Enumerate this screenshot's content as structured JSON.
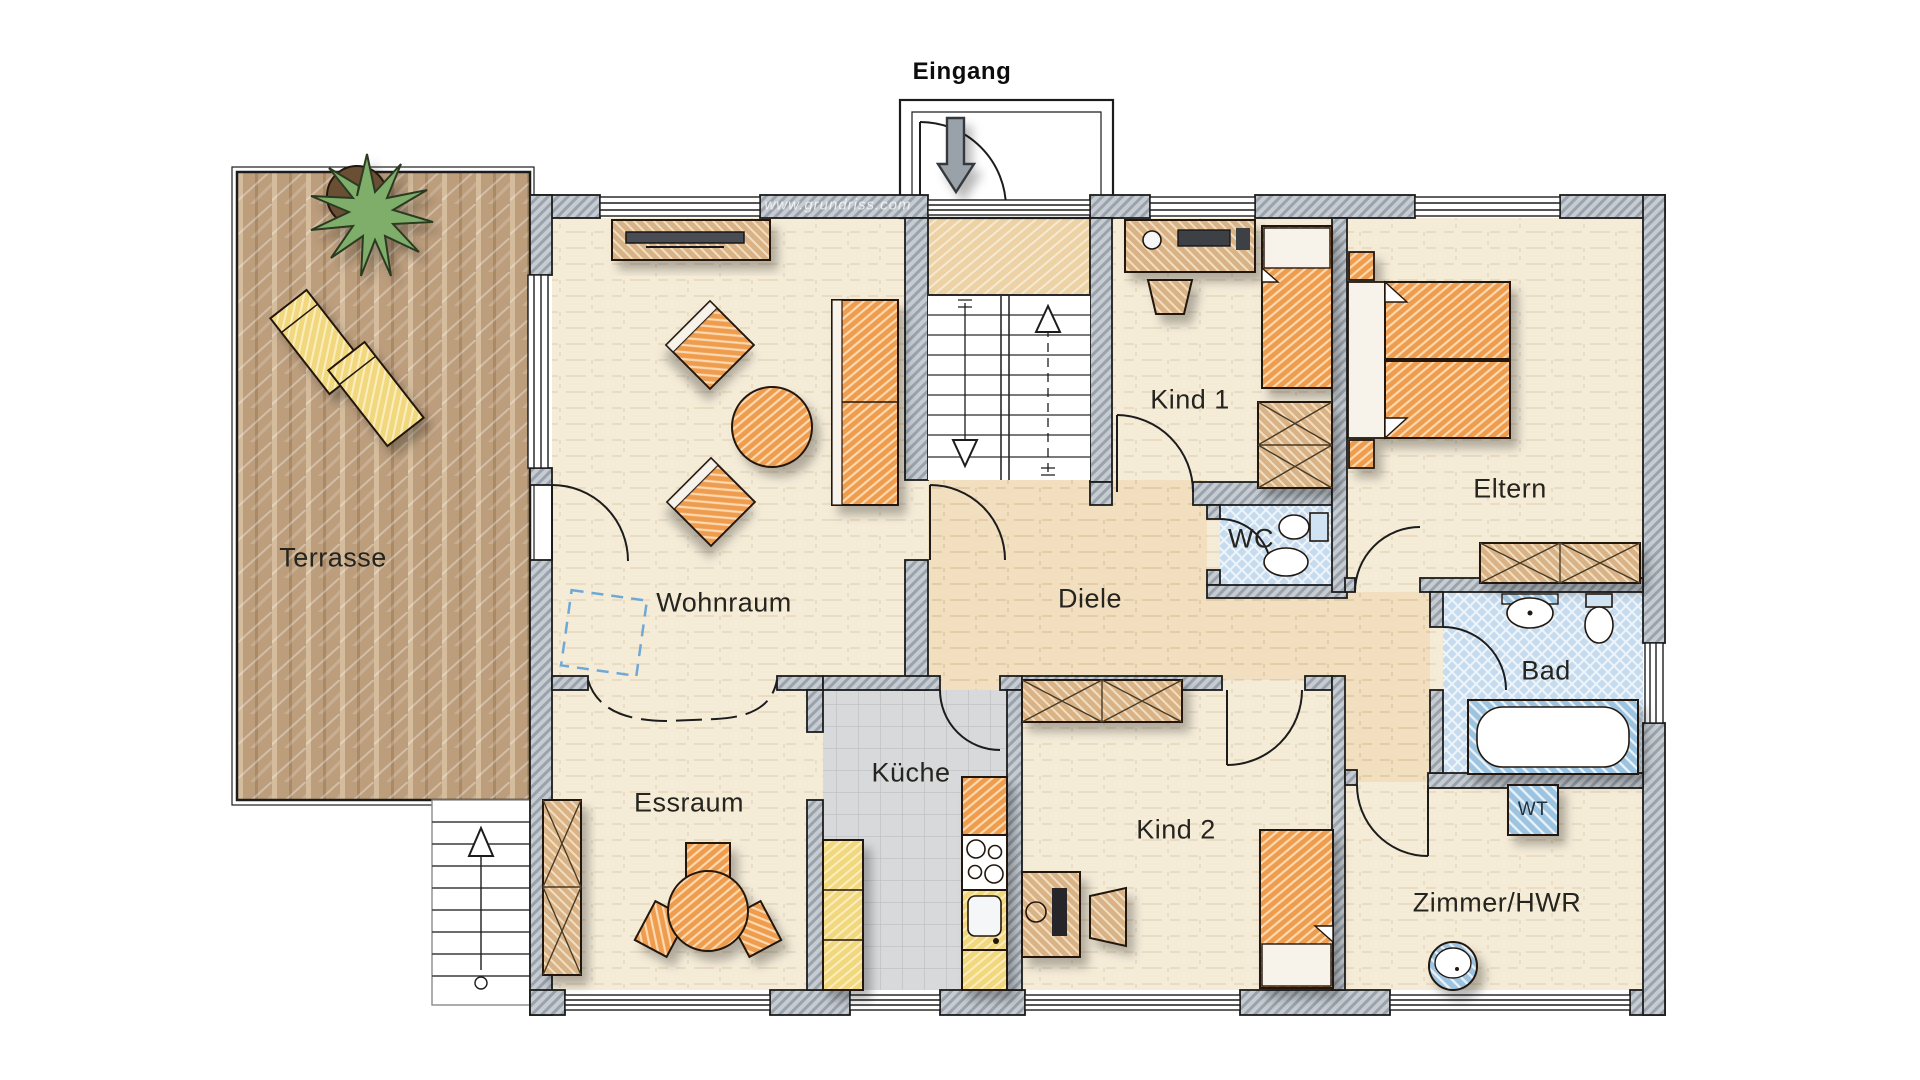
{
  "plan": {
    "entrance_label": "Eingang",
    "watermark": "www.grundriss.com",
    "rooms": {
      "terrasse": {
        "label": "Terrasse"
      },
      "wohnraum": {
        "label": "Wohnraum"
      },
      "diele": {
        "label": "Diele"
      },
      "kind1": {
        "label": "Kind 1"
      },
      "eltern": {
        "label": "Eltern"
      },
      "wc": {
        "label": "WC"
      },
      "bad": {
        "label": "Bad"
      },
      "essraum": {
        "label": "Essraum"
      },
      "kueche": {
        "label": "Küche"
      },
      "kind2": {
        "label": "Kind 2"
      },
      "zimmer_hwr": {
        "label": "Zimmer/HWR"
      }
    },
    "appliances": {
      "wt": {
        "label": "WT"
      }
    },
    "colors": {
      "wall_gray": "#c2c8ce",
      "floor_cream": "#f5ecd8",
      "floor_warm": "#f1dfc0",
      "terrace_brown": "#bc9e7d",
      "furniture_orange": "#ee9c4e",
      "furniture_tan": "#d9b285",
      "bath_blue": "#c6dbee",
      "kitchen_yellow": "#f1d87e",
      "tile_gray": "#d8d9db",
      "plant_green": "#7fae6a",
      "line_black": "#1c1c1c"
    }
  }
}
